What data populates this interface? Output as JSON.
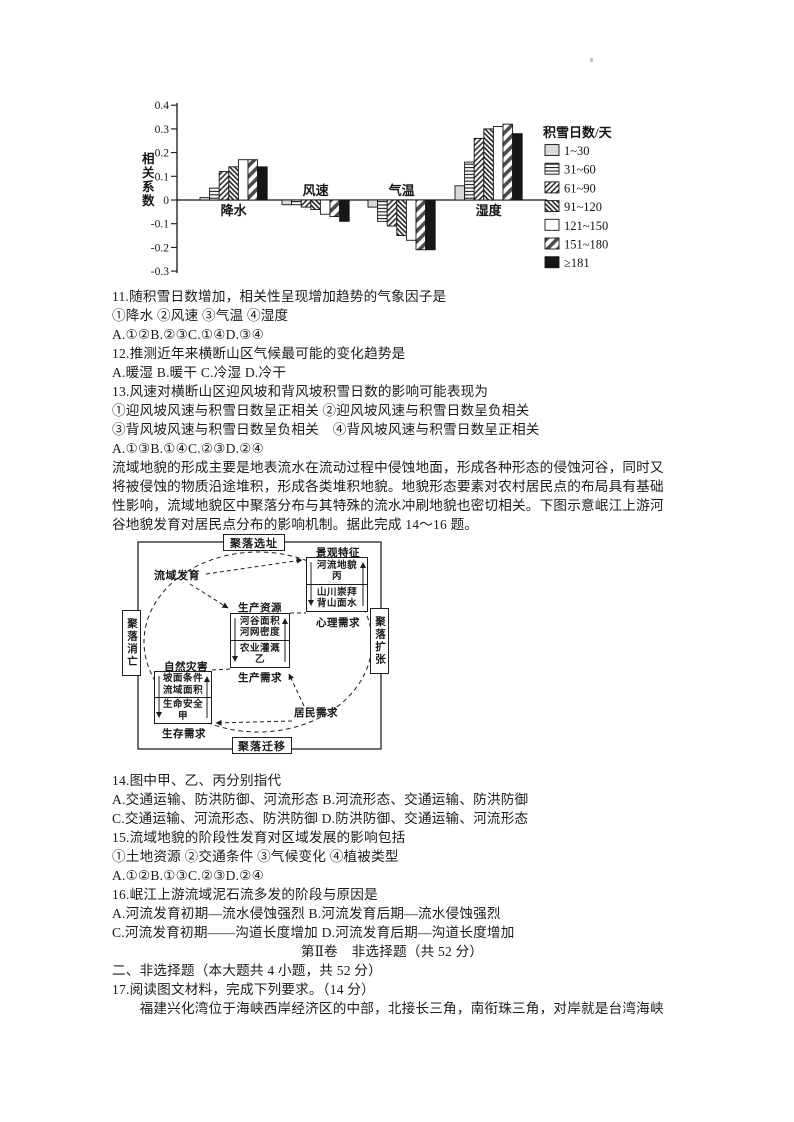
{
  "chart_data": {
    "type": "bar",
    "title": "",
    "ylabel": "相关系数",
    "legend_title": "积雪日数/天",
    "categories": [
      "降水",
      "风速",
      "气温",
      "湿度"
    ],
    "series": [
      {
        "name": "1~30",
        "pattern": "lightgray",
        "values": [
          0.01,
          -0.02,
          -0.03,
          0.06
        ]
      },
      {
        "name": "31~60",
        "pattern": "hlines",
        "values": [
          0.05,
          -0.02,
          -0.09,
          0.16
        ]
      },
      {
        "name": "61~90",
        "pattern": "diag-dense",
        "values": [
          0.12,
          -0.03,
          -0.11,
          0.26
        ]
      },
      {
        "name": "91~120",
        "pattern": "diag-back",
        "values": [
          0.14,
          -0.04,
          -0.15,
          0.3
        ]
      },
      {
        "name": "121~150",
        "pattern": "white",
        "values": [
          0.17,
          -0.06,
          -0.17,
          0.31
        ]
      },
      {
        "name": "151~180",
        "pattern": "diag-broad",
        "values": [
          0.17,
          -0.07,
          -0.21,
          0.32
        ]
      },
      {
        "name": "≥181",
        "pattern": "black",
        "values": [
          0.14,
          -0.09,
          -0.21,
          0.28
        ]
      }
    ],
    "ylim": [
      -0.3,
      0.4
    ],
    "ytick_step": 0.1,
    "grid": false,
    "legend_position": "right",
    "ink_color": "#161616"
  },
  "text": {
    "q11": "11.随积雪日数增加，相关性呈现增加趋势的气象因子是",
    "q11_opts": "①降水 ②风速 ③气温 ④湿度",
    "q11_ans": "A.①②B.②③C.①④D.③④",
    "q12": "12.推测近年来横断山区气候最可能的变化趋势是",
    "q12_ans": "A.暖湿 B.暖干 C.冷湿 D.冷干",
    "q13": "13.风速对横断山区迎风坡和背风坡积雪日数的影响可能表现为",
    "q13_opts1": "①迎风坡风速与积雪日数呈正相关 ②迎风坡风速与积雪日数呈负相关",
    "q13_opts2": "③背风坡风速与积雪日数呈负相关　④背风坡风速与积雪日数呈正相关",
    "q13_ans": "A.①③B.①④C.②③D.②④",
    "para1_l1": "流域地貌的形成主要是地表流水在流动过程中侵蚀地面，形成各种形态的侵蚀河谷，同时又",
    "para1_l2": "将被侵蚀的物质沿途堆积，形成各类堆积地貌。地貌形态要素对农村居民点的布局具有基础",
    "para1_l3": "性影响，流域地貌区中聚落分布与其特殊的流水冲刷地貌也密切相关。下图示意岷江上游河",
    "para1_l4": "谷地貌发育对居民点分布的影响机制。据此完成 14～16 题。",
    "q14": "14.图中甲、乙、丙分别指代",
    "q14_ab": "A.交通运输、防洪防御、河流形态 B.河流形态、交通运输、防洪防御",
    "q14_cd": "C.交通运输、河流形态、防洪防御 D.防洪防御、交通运输、河流形态",
    "q15": "15.流域地貌的阶段性发育对区域发展的影响包括",
    "q15_opts": "①土地资源 ②交通条件 ③气候变化 ④植被类型",
    "q15_ans": "A.①②B.①③C.②③D.②④",
    "q16": "16.岷江上游流域泥石流多发的阶段与原因是",
    "q16_ab": "A.河流发育初期—流水侵蚀强烈 B.河流发育后期—流水侵蚀强烈",
    "q16_cd": "C.河流发育初期——沟道长度增加 D.河流发育后期—沟道长度增加",
    "section2_title": "第Ⅱ卷　非选择题（共 52 分）",
    "section2_head": "二、非选择题（本大题共 4 小题，共 52 分）",
    "q17": "17.阅读图文材料，完成下列要求。（14 分）",
    "q17_para": "　　福建兴化湾位于海峡西岸经济区的中部，北接长三角，南衔珠三角，对岸就是台湾海峡"
  },
  "diagram": {
    "outer": {
      "top": "聚落选址",
      "bottom": "聚落迁移",
      "left": "聚落消亡",
      "right": "聚落扩张"
    },
    "labels": {
      "watershed": "流域发育",
      "landscape": "景观特征",
      "psych": "心理需求",
      "resource": "生产资源",
      "production": "生产需求",
      "disaster": "自然灾害",
      "survival": "生存需求",
      "residents": "居民需求"
    },
    "box_landscape": {
      "l1": "河流地貌",
      "l2": "丙",
      "l3": "山川崇拜",
      "l4": "背山面水"
    },
    "box_resource": {
      "l1": "河谷面积",
      "l2": "河网密度",
      "l3": "农业灌溉",
      "l4": "乙"
    },
    "box_disaster": {
      "l1": "坡面条件",
      "l2": "流域面积",
      "l3": "生命安全",
      "l4": "甲"
    }
  }
}
